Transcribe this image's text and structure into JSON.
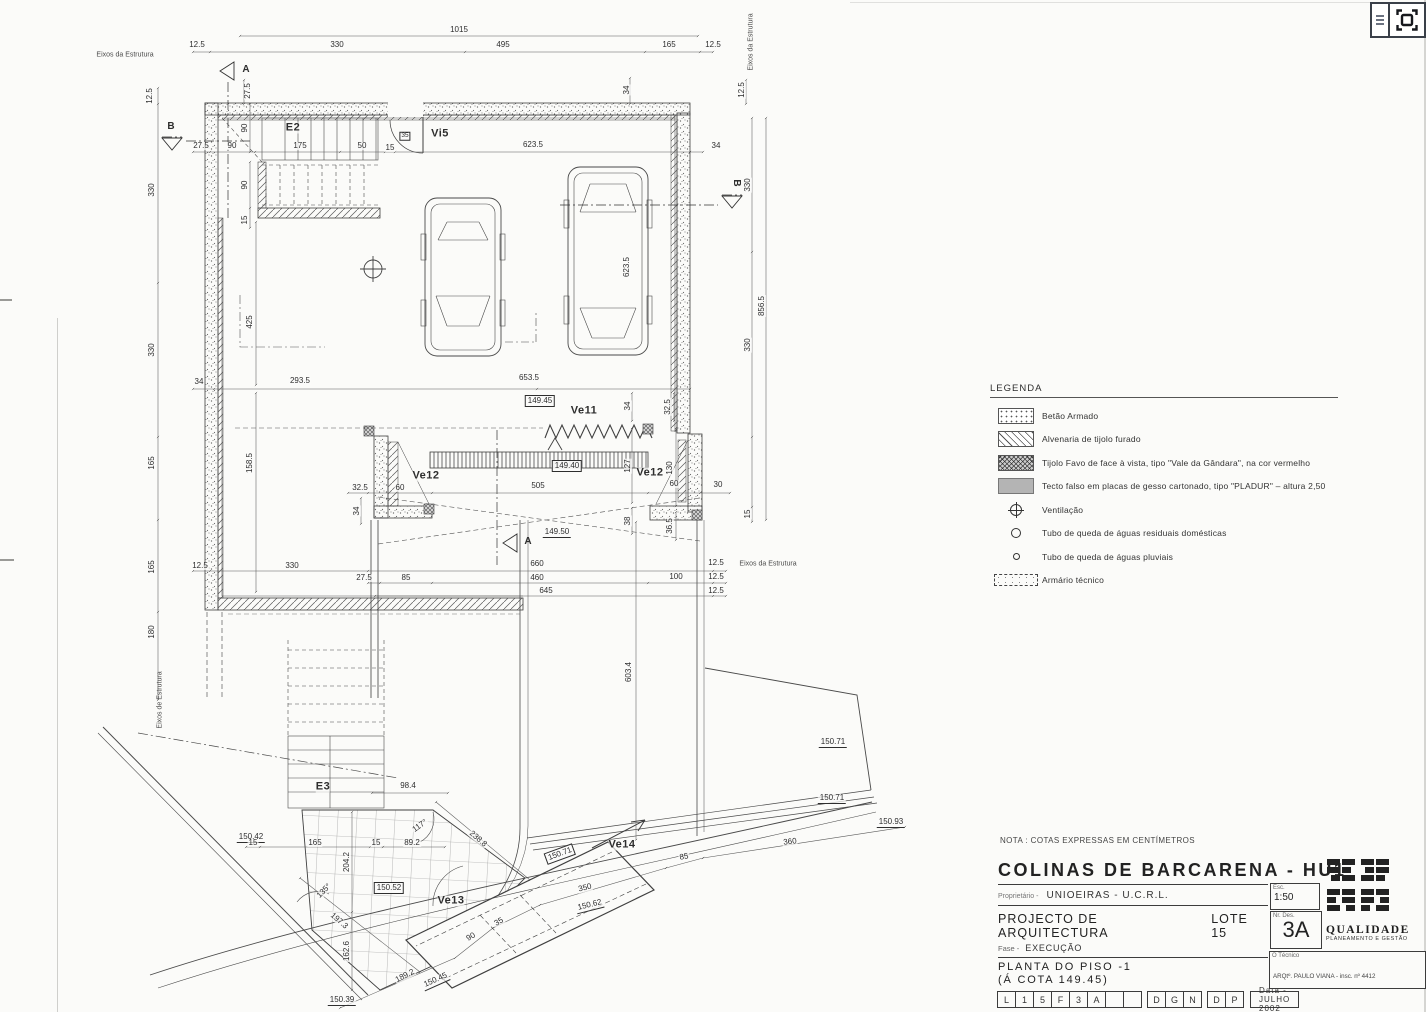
{
  "viewer": {
    "menu_icon": "menu",
    "fullscreen_icon": "fit-to-screen"
  },
  "nota": "NOTA : COTAS EXPRESSAS EM CENTÍMETROS",
  "legend": {
    "title": "LEGENDA",
    "items": [
      {
        "swatch": "stipple",
        "label": "Betão  Armado"
      },
      {
        "swatch": "hatch",
        "label": "Alvenaria de tijolo furado"
      },
      {
        "swatch": "crosshatch",
        "label": "Tijolo Favo de face à vista, tipo \"Vale da Gândara\", na cor vermelho"
      },
      {
        "swatch": "gray",
        "label": "Tecto falso em placas de gesso cartonado, tipo \"PLADUR\" – altura 2,50"
      },
      {
        "swatch": "vent",
        "label": "Ventilação"
      },
      {
        "swatch": "circle-large",
        "label": "Tubo de queda de águas residuais domésticas"
      },
      {
        "swatch": "circle-small",
        "label": "Tubo de queda de águas pluviais"
      },
      {
        "swatch": "dashed-box",
        "label": "Armário técnico"
      }
    ]
  },
  "titleblock": {
    "project": "COLINAS DE BARCARENA - HU1",
    "owner_label": "Proprietário -",
    "owner": "UNIOEIRAS - U.C.R.L.",
    "doc_type": "PROJECTO DE ARQUITECTURA",
    "lot": "LOTE 15",
    "phase_label": "Fase -",
    "phase": "EXECUÇÃO",
    "drawing_title_1": "PLANTA DO PISO -1",
    "drawing_title_2": "(Á COTA 149.45)",
    "scale_label": "Esc.",
    "scale": "1:50",
    "number_label": "Nr. Des.",
    "number": "3A",
    "code_groups": [
      [
        "L",
        "1",
        "5",
        "F",
        "3",
        "A",
        "",
        ""
      ],
      [
        "D",
        "G",
        "N"
      ],
      [
        "D",
        "P"
      ]
    ],
    "date": "Data - JULHO 2002",
    "technician_label": "O Técnico",
    "architect": "ARQtº. PAULO VIANA - insc. nº 4412",
    "logo": {
      "line1": "QUALIDADE",
      "line2": "PLANEAMENTO E GESTÃO",
      "vertical1": "URBANA",
      "vertical2": "DE SISTEMAS URBANOS LDA"
    }
  },
  "plan": {
    "annotations": [
      {
        "t": "1015",
        "x": 459,
        "y": 30
      },
      {
        "t": "12.5",
        "x": 197,
        "y": 45
      },
      {
        "t": "330",
        "x": 337,
        "y": 45
      },
      {
        "t": "495",
        "x": 503,
        "y": 45
      },
      {
        "t": "165",
        "x": 669,
        "y": 45
      },
      {
        "t": "12.5",
        "x": 713,
        "y": 45
      },
      {
        "t": "12.5",
        "x": 150,
        "y": 96,
        "r": -90
      },
      {
        "t": "27.5",
        "x": 248,
        "y": 91,
        "r": -90
      },
      {
        "t": "34",
        "x": 627,
        "y": 90,
        "r": -90
      },
      {
        "t": "12.5",
        "x": 742,
        "y": 90,
        "r": -90
      },
      {
        "t": "27.5",
        "x": 201,
        "y": 146
      },
      {
        "t": "90",
        "x": 232,
        "y": 146
      },
      {
        "t": "175",
        "x": 300,
        "y": 146
      },
      {
        "t": "50",
        "x": 362,
        "y": 146
      },
      {
        "t": "15",
        "x": 390,
        "y": 148
      },
      {
        "t": "623.5",
        "x": 533,
        "y": 145
      },
      {
        "t": "34",
        "x": 716,
        "y": 146
      },
      {
        "t": "90",
        "x": 245,
        "y": 128,
        "r": -90
      },
      {
        "t": "90",
        "x": 245,
        "y": 185,
        "r": -90
      },
      {
        "t": "15",
        "x": 245,
        "y": 220,
        "r": -90
      },
      {
        "t": "330",
        "x": 152,
        "y": 190,
        "r": -90
      },
      {
        "t": "330",
        "x": 152,
        "y": 350,
        "r": -90
      },
      {
        "t": "165",
        "x": 152,
        "y": 463,
        "r": -90
      },
      {
        "t": "165",
        "x": 152,
        "y": 567,
        "r": -90
      },
      {
        "t": "180",
        "x": 152,
        "y": 632,
        "r": -90
      },
      {
        "t": "330",
        "x": 748,
        "y": 185,
        "r": -90
      },
      {
        "t": "856.5",
        "x": 762,
        "y": 306,
        "r": -90
      },
      {
        "t": "330",
        "x": 748,
        "y": 345,
        "r": -90
      },
      {
        "t": "623.5",
        "x": 627,
        "y": 267,
        "r": -90
      },
      {
        "t": "425",
        "x": 250,
        "y": 322,
        "r": -90
      },
      {
        "t": "34",
        "x": 199,
        "y": 382
      },
      {
        "t": "293.5",
        "x": 300,
        "y": 381
      },
      {
        "t": "653.5",
        "x": 529,
        "y": 378
      },
      {
        "t": "158.5",
        "x": 250,
        "y": 463,
        "r": -90
      },
      {
        "t": "149.45",
        "x": 540,
        "y": 401,
        "s": "B"
      },
      {
        "t": "Ve11",
        "x": 584,
        "y": 411,
        "s": "L"
      },
      {
        "t": "34",
        "x": 628,
        "y": 406,
        "r": -90
      },
      {
        "t": "32.5",
        "x": 668,
        "y": 407,
        "r": -90
      },
      {
        "t": "Ve12",
        "x": 426,
        "y": 476,
        "s": "L"
      },
      {
        "t": "Ve12",
        "x": 650,
        "y": 473,
        "s": "L"
      },
      {
        "t": "149.40",
        "x": 567,
        "y": 466,
        "s": "B"
      },
      {
        "t": "127",
        "x": 628,
        "y": 466,
        "r": -90
      },
      {
        "t": "130",
        "x": 670,
        "y": 468,
        "r": -90
      },
      {
        "t": "32.5",
        "x": 360,
        "y": 488
      },
      {
        "t": "60",
        "x": 400,
        "y": 488
      },
      {
        "t": "505",
        "x": 538,
        "y": 486
      },
      {
        "t": "60",
        "x": 674,
        "y": 484
      },
      {
        "t": "30",
        "x": 718,
        "y": 485
      },
      {
        "t": "34",
        "x": 357,
        "y": 511,
        "r": -90
      },
      {
        "t": "38",
        "x": 628,
        "y": 521,
        "r": -90
      },
      {
        "t": "36.5",
        "x": 670,
        "y": 526,
        "r": -90
      },
      {
        "t": "15",
        "x": 748,
        "y": 514,
        "r": -90
      },
      {
        "t": "149.50",
        "x": 557,
        "y": 533,
        "s": "u"
      },
      {
        "t": "12.5",
        "x": 200,
        "y": 566
      },
      {
        "t": "330",
        "x": 292,
        "y": 566
      },
      {
        "t": "27.5",
        "x": 364,
        "y": 578
      },
      {
        "t": "85",
        "x": 406,
        "y": 578
      },
      {
        "t": "660",
        "x": 537,
        "y": 564
      },
      {
        "t": "460",
        "x": 537,
        "y": 578
      },
      {
        "t": "100",
        "x": 676,
        "y": 577
      },
      {
        "t": "645",
        "x": 546,
        "y": 591
      },
      {
        "t": "12.5",
        "x": 716,
        "y": 563
      },
      {
        "t": "12.5",
        "x": 716,
        "y": 577
      },
      {
        "t": "12.5",
        "x": 716,
        "y": 591
      },
      {
        "t": "603.4",
        "x": 629,
        "y": 672,
        "r": -90
      },
      {
        "t": "E2",
        "x": 293,
        "y": 128,
        "s": "L"
      },
      {
        "t": "35",
        "x": 405,
        "y": 136,
        "s": "b"
      },
      {
        "t": "Vi5",
        "x": 440,
        "y": 134,
        "s": "L"
      },
      {
        "t": "E3",
        "x": 323,
        "y": 787,
        "s": "L"
      },
      {
        "t": "98.4",
        "x": 408,
        "y": 786
      },
      {
        "t": "150.42",
        "x": 251,
        "y": 838,
        "s": "u"
      },
      {
        "t": "15",
        "x": 253,
        "y": 843
      },
      {
        "t": "165",
        "x": 315,
        "y": 843
      },
      {
        "t": "15",
        "x": 376,
        "y": 843
      },
      {
        "t": "89.2",
        "x": 412,
        "y": 843
      },
      {
        "t": "204.2",
        "x": 347,
        "y": 862,
        "r": -90
      },
      {
        "t": "162.6",
        "x": 347,
        "y": 951,
        "r": -90
      },
      {
        "t": "150.52",
        "x": 389,
        "y": 888,
        "s": "B"
      },
      {
        "t": "238.8",
        "x": 478,
        "y": 839,
        "r": 41
      },
      {
        "t": "117°",
        "x": 420,
        "y": 826,
        "r": -35
      },
      {
        "t": "135°",
        "x": 324,
        "y": 891,
        "r": -45
      },
      {
        "t": "197.3",
        "x": 339,
        "y": 921,
        "r": 41
      },
      {
        "t": "Ve13",
        "x": 451,
        "y": 901,
        "s": "L"
      },
      {
        "t": "Ve14",
        "x": 622,
        "y": 845,
        "s": "L"
      },
      {
        "t": "189.2",
        "x": 405,
        "y": 976,
        "r": -27
      },
      {
        "t": "90",
        "x": 471,
        "y": 937,
        "r": -30
      },
      {
        "t": "35",
        "x": 499,
        "y": 922,
        "r": -30
      },
      {
        "t": "350",
        "x": 585,
        "y": 888,
        "r": -14
      },
      {
        "t": "85",
        "x": 684,
        "y": 857,
        "r": -10
      },
      {
        "t": "360",
        "x": 790,
        "y": 842,
        "r": -7
      },
      {
        "t": "150.62",
        "x": 590,
        "y": 906,
        "r": -14,
        "s": "u"
      },
      {
        "t": "150.45",
        "x": 436,
        "y": 981,
        "r": -24,
        "s": "u"
      },
      {
        "t": "150.39",
        "x": 342,
        "y": 1001,
        "s": "u"
      },
      {
        "t": "150.71",
        "x": 560,
        "y": 854,
        "r": -20,
        "s": "B"
      },
      {
        "t": "150.71",
        "x": 833,
        "y": 743,
        "s": "u"
      },
      {
        "t": "150.71",
        "x": 832,
        "y": 799,
        "s": "u"
      },
      {
        "t": "150.93",
        "x": 891,
        "y": 823,
        "s": "u"
      },
      {
        "t": "A",
        "x": 246,
        "y": 70,
        "s": "s"
      },
      {
        "t": "A",
        "x": 528,
        "y": 542,
        "s": "s"
      },
      {
        "t": "B",
        "x": 171,
        "y": 127,
        "s": "s"
      },
      {
        "t": "B",
        "x": 736,
        "y": 183,
        "r": 90,
        "s": "s"
      },
      {
        "t": "Eixos da Estrutura",
        "x": 125,
        "y": 55,
        "s": "e"
      },
      {
        "t": "Eixos da Estrutura",
        "x": 751,
        "y": 42,
        "r": -90,
        "s": "e"
      },
      {
        "t": "Eixos da Estrutura",
        "x": 768,
        "y": 564,
        "s": "e"
      },
      {
        "t": "Eixos de Estrutura",
        "x": 160,
        "y": 700,
        "r": -90,
        "s": "e"
      }
    ]
  }
}
